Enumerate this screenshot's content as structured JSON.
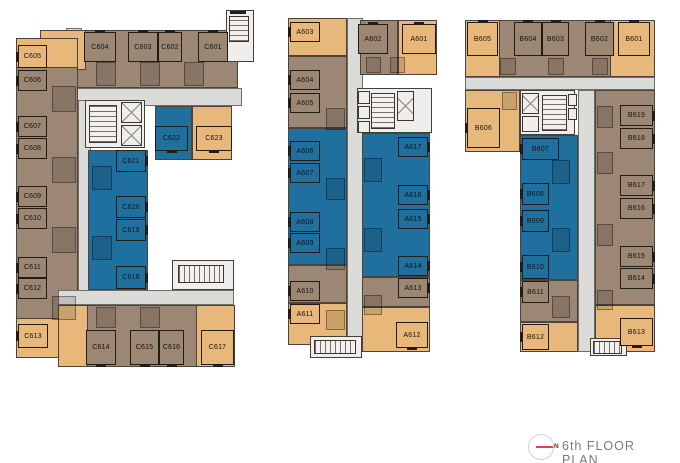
{
  "title": {
    "text": "6th FLOOR PLAN",
    "compass_label": "N"
  },
  "colors": {
    "unit_tan": "#e8b87b",
    "unit_brown": "#9c8674",
    "unit_blue": "#20709f",
    "corridor": "#dbdbd9",
    "core_gray": "#efeeec",
    "wall": "#211c16",
    "accent_red": "#e8413a",
    "title_text": "#7a7a7a"
  },
  "buildings": {
    "c": {
      "units": [
        {
          "label": "C601",
          "category": "brown"
        },
        {
          "label": "C602",
          "category": "brown"
        },
        {
          "label": "C603",
          "category": "brown"
        },
        {
          "label": "C604",
          "category": "brown"
        },
        {
          "label": "C605",
          "category": "tan"
        },
        {
          "label": "C606",
          "category": "brown"
        },
        {
          "label": "C607",
          "category": "brown"
        },
        {
          "label": "C608",
          "category": "brown"
        },
        {
          "label": "C609",
          "category": "brown"
        },
        {
          "label": "C610",
          "category": "brown"
        },
        {
          "label": "C611",
          "category": "brown"
        },
        {
          "label": "C612",
          "category": "brown"
        },
        {
          "label": "C613",
          "category": "tan"
        },
        {
          "label": "C614",
          "category": "brown"
        },
        {
          "label": "C615",
          "category": "brown"
        },
        {
          "label": "C616",
          "category": "brown"
        },
        {
          "label": "C617",
          "category": "tan"
        },
        {
          "label": "C618",
          "category": "blue"
        },
        {
          "label": "C619",
          "category": "blue"
        },
        {
          "label": "C620",
          "category": "blue"
        },
        {
          "label": "C621",
          "category": "blue"
        },
        {
          "label": "C622",
          "category": "blue"
        },
        {
          "label": "C623",
          "category": "tan"
        }
      ]
    },
    "a": {
      "units": [
        {
          "label": "A601",
          "category": "tan"
        },
        {
          "label": "A602",
          "category": "brown"
        },
        {
          "label": "A603",
          "category": "tan"
        },
        {
          "label": "A604",
          "category": "brown"
        },
        {
          "label": "A605",
          "category": "brown"
        },
        {
          "label": "A606",
          "category": "blue"
        },
        {
          "label": "A607",
          "category": "blue"
        },
        {
          "label": "A608",
          "category": "blue"
        },
        {
          "label": "A609",
          "category": "blue"
        },
        {
          "label": "A610",
          "category": "brown"
        },
        {
          "label": "A611",
          "category": "tan"
        },
        {
          "label": "A612",
          "category": "tan"
        },
        {
          "label": "A613",
          "category": "brown"
        },
        {
          "label": "A614",
          "category": "blue"
        },
        {
          "label": "A615",
          "category": "blue"
        },
        {
          "label": "A616",
          "category": "blue"
        },
        {
          "label": "A617",
          "category": "blue"
        }
      ]
    },
    "b": {
      "units": [
        {
          "label": "B601",
          "category": "tan"
        },
        {
          "label": "B602",
          "category": "brown"
        },
        {
          "label": "B603",
          "category": "brown"
        },
        {
          "label": "B604",
          "category": "brown"
        },
        {
          "label": "B605",
          "category": "tan"
        },
        {
          "label": "B606",
          "category": "tan"
        },
        {
          "label": "B607",
          "category": "blue"
        },
        {
          "label": "B608",
          "category": "blue"
        },
        {
          "label": "B609",
          "category": "blue"
        },
        {
          "label": "B610",
          "category": "blue"
        },
        {
          "label": "B611",
          "category": "brown"
        },
        {
          "label": "B612",
          "category": "tan"
        },
        {
          "label": "B613",
          "category": "tan"
        },
        {
          "label": "B614",
          "category": "brown"
        },
        {
          "label": "B615",
          "category": "brown"
        },
        {
          "label": "B616",
          "category": "brown"
        },
        {
          "label": "B617",
          "category": "brown"
        },
        {
          "label": "B618",
          "category": "brown"
        },
        {
          "label": "B619",
          "category": "brown"
        }
      ]
    }
  }
}
